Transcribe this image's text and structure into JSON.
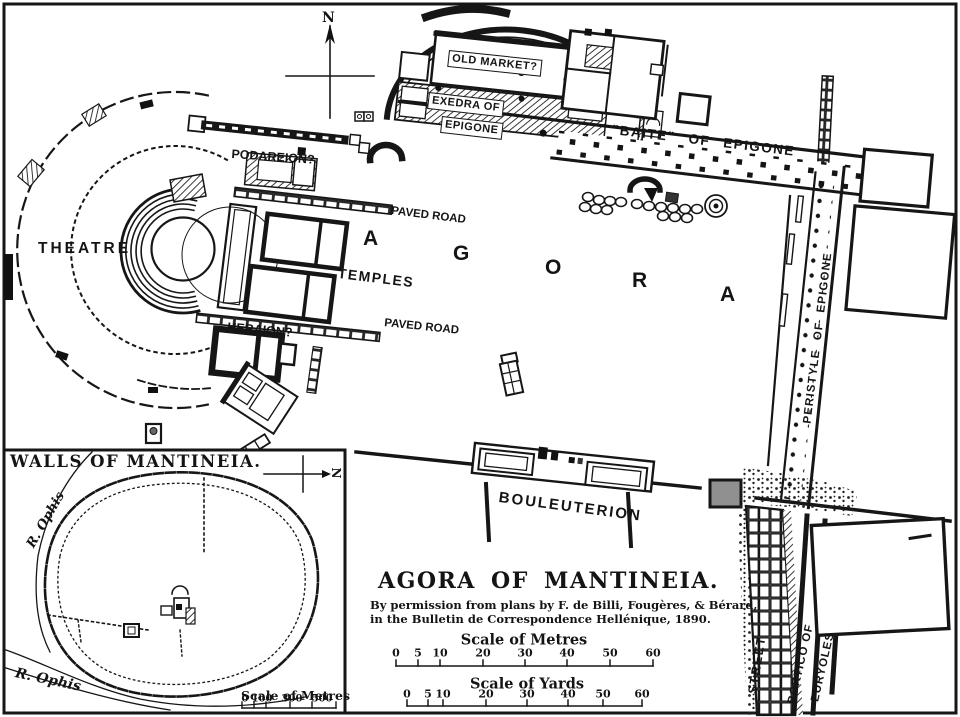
{
  "colors": {
    "ink": "#161616",
    "paper": "#ffffff",
    "gray_block": "#909090"
  },
  "plan": {
    "compass_label": "N",
    "labels": {
      "old_market": "OLD MARKET?",
      "exedra_line1": "EXEDRA OF",
      "exedra_line2": "EPIGONE",
      "baite": "\"BAITE\"  OF  EPIGONE",
      "podareion": "PODAREION?",
      "paved_road_upper": "PAVED ROAD",
      "paved_road_lower": "PAVED ROAD",
      "theatre": "THEATRE",
      "temples": "TEMPLES",
      "heraion": "HERAION?",
      "agora_letters": [
        "A",
        "G",
        "O",
        "R",
        "A"
      ],
      "peristyle": "PERISTYLE  OF  EPIGONE",
      "bouleuterion": "BOULEUTERION",
      "street": "STREET",
      "portico_line1": "PORTICO OF",
      "portico_line2": "EURYOLES"
    },
    "title_block": {
      "title": "AGORA OF MANTINEIA.",
      "attribution_line1": "By permission from plans by F. de Billi, Fougères, & Bérard,",
      "attribution_line2": "in the Bulletin de Correspondence Hellénique, 1890."
    },
    "scales": {
      "metres": {
        "title": "Scale of Metres",
        "ticks": [
          "0",
          "5",
          "10",
          "20",
          "30",
          "40",
          "50",
          "60"
        ]
      },
      "yards": {
        "title": "Scale of Yards",
        "ticks": [
          "0",
          "5",
          "10",
          "20",
          "30",
          "40",
          "50",
          "60"
        ]
      }
    }
  },
  "inset": {
    "title": "WALLS OF MANTINEIA.",
    "compass_label": "N",
    "river_upper": "R. Ophis",
    "river_lower": "R. Ophis",
    "scale": {
      "title": "Scale of Metres",
      "ticks": [
        "0",
        "100",
        "300",
        "500"
      ]
    }
  }
}
